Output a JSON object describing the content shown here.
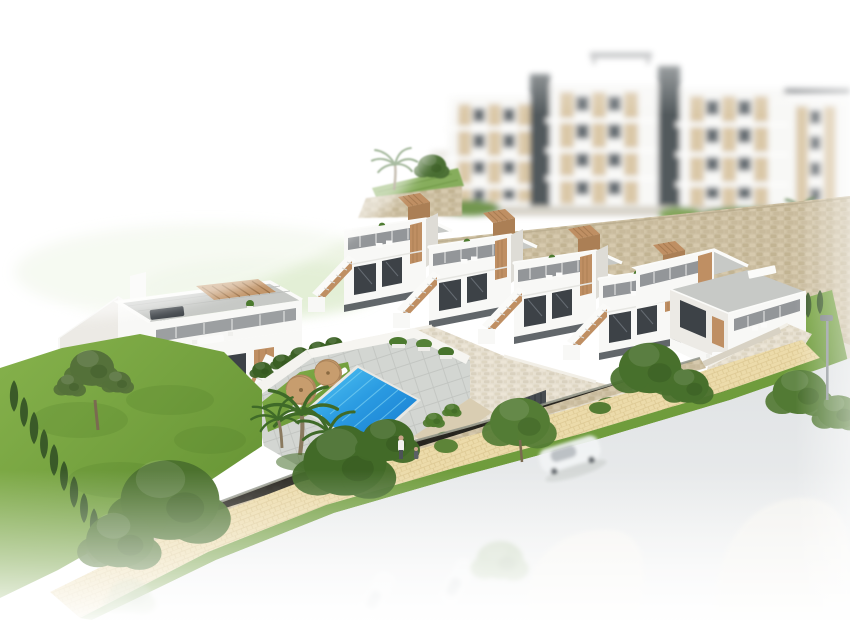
{
  "meta": {
    "title": "Aerial 3D architectural render of a coastal residential development: white townhouses with roof terraces and wooden accents, communal swimming pool with sun loungers, blurred apartment blocks behind a stone retaining wall, landscaped gardens and a street fading to white",
    "style": "photoreal render, white vignette edges, background and foreground blur"
  },
  "scene": {
    "background": {
      "apartment_blocks": 4,
      "elevator_towers": 2,
      "background_pool": {
        "present": true,
        "water_color": "#58c2cf",
        "parasols": 1,
        "palms": 1
      },
      "stone_retaining_wall": {
        "material": "tan rubble stone",
        "runs": "behind townhouse row"
      },
      "terrace_garden": {
        "palms": 1,
        "pines": 1
      }
    },
    "midground": {
      "townhouse_row_units": 4,
      "corner_townhouse": {
        "roof_furniture_color": "teal",
        "white_canopy": true
      },
      "unit_features": [
        "grey roof deck",
        "wood slat chimney box",
        "external staircase with wood parapet",
        "dark glass balustrade terrace",
        "dark recessed windows",
        "wood accent panels",
        "dark ground fence"
      ],
      "left_villa": {
        "pergola": "wood slats",
        "roof_sofa": "dark grey",
        "dining_set": "white",
        "staircase": true
      },
      "cream_retaining_wall": {
        "garage_opening": 1,
        "parked_car_color": "silver",
        "driveway": true
      }
    },
    "pool_area": {
      "pool_water_colors": [
        "#4cc2f2",
        "#1478cf"
      ],
      "sun_loungers": 6,
      "parasols": 2,
      "lawn_strip": true,
      "paving": "grey stone pavers",
      "planter_trees": 3,
      "pedestrians": 2
    },
    "landscape": {
      "garden_lawn": true,
      "cypress_row_count": 9,
      "pine_tree": 1,
      "palm_cluster_palms": 3,
      "street_trees": 6,
      "hedge_row": true
    },
    "street": {
      "sidewalk": "cream pavers",
      "grass_verge": true,
      "boundary_wall": "low stone wall with dark gate",
      "road_color": "#e1e4e6",
      "driving_car_color": "white",
      "ghost_cars": 2,
      "ghost_islands": 2,
      "street_lamp": 1
    }
  },
  "palette": {
    "white_building": "#f8f8f6",
    "building_shadow": "#eceae5",
    "roof_deck": "#c7c9c6",
    "wood_accent": "#bf8f63",
    "window_dark": "#3d4247",
    "stone_tan": "#cdc0a3",
    "stone_cream": "#e6dfd0",
    "paver_grey": "#d3d6d2",
    "sidewalk_cream": "#ecdbaa",
    "grass_bright": "#7cab45",
    "grass_dark": "#55802c",
    "tree_green": "#4e7a2e",
    "cypress_dark": "#3a5a28",
    "pool_light": "#4cc2f2",
    "pool_deep": "#1478cf",
    "bg_pool": "#58c2cf",
    "road_grey": "#e1e4e6",
    "car_silver": "#b9bdc1"
  }
}
